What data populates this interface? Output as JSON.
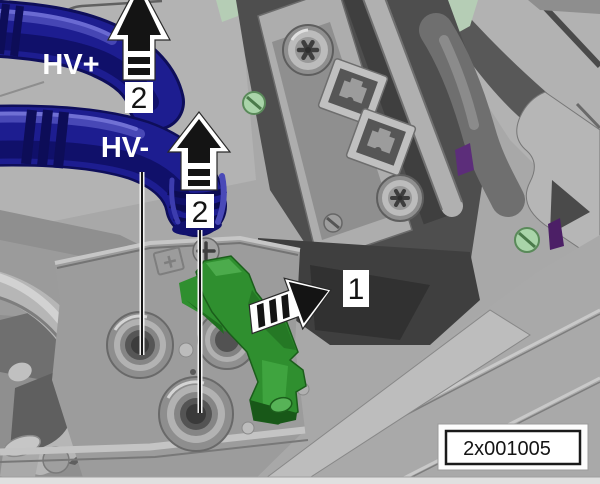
{
  "figure": {
    "type": "service-manual-illustration",
    "part_code": "2x001005",
    "labels": {
      "hv_plus": "HV+",
      "hv_minus": "HV-"
    },
    "callouts": {
      "step1": "1",
      "step2_upper": "2",
      "step2_lower": "2"
    },
    "arrows": [
      {
        "name": "disconnect-hv-plus-arrow",
        "direction": "up",
        "style": "striped-shaft",
        "callout": "2"
      },
      {
        "name": "disconnect-hv-minus-arrow",
        "direction": "up",
        "style": "striped-shaft",
        "callout": "2"
      },
      {
        "name": "release-lever-arrow",
        "direction": "right",
        "style": "striped-tail",
        "callout": "1"
      }
    ],
    "colors": {
      "background": "#a8a8a8",
      "hv_cable_blue": "#1d1d90",
      "cable_shadow_blue": "#0d0d55",
      "cable_highlight_blue": "#5050c0",
      "lever_green": "#2f8f2f",
      "label_text_white": "#ffffff",
      "annotation_black": "#141414",
      "panel_dark": "#4e4e4e",
      "screw_green": "#a9d4a9",
      "accent_purple": "#5c2d7a"
    }
  }
}
